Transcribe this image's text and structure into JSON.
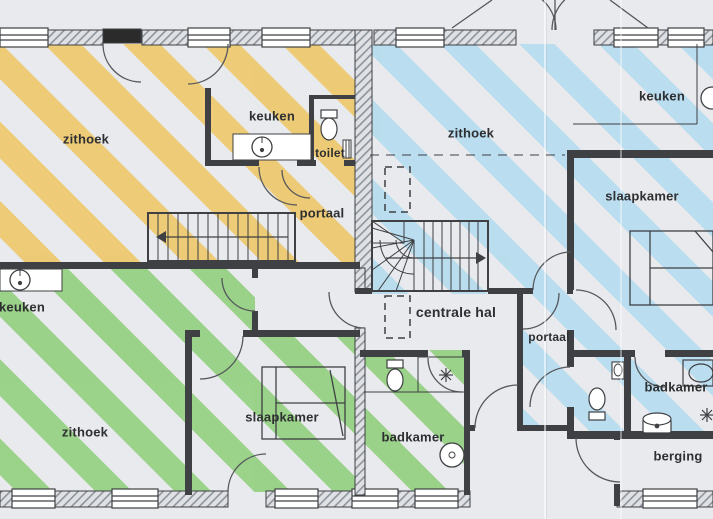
{
  "floorplan": {
    "type": "scanned architectural floor plan, three apartments marked with coloured highlighter stripes",
    "apartments": {
      "yellow": {
        "color": "#eec769",
        "rooms": {
          "zithoek": "zithoek",
          "keuken": "keuken",
          "toilet": "toilet",
          "portaal": "portaal"
        }
      },
      "blue": {
        "color": "#b5dcef",
        "rooms": {
          "zithoek": "zithoek",
          "keuken": "keuken",
          "slaapkamer": "slaapkamer",
          "portaal": "portaal",
          "badkamer": "badkamer",
          "berging": "berging"
        }
      },
      "green": {
        "color": "#92d07f",
        "rooms": {
          "keuken": "keuken",
          "zithoek": "zithoek",
          "slaapkamer": "slaapkamer",
          "badkamer": "badkamer"
        }
      }
    },
    "shared": {
      "centrale_hal": "centrale hal"
    },
    "colors": {
      "wall": "#3e4043",
      "paper": "#e9eaed",
      "hatch_line": "#8e949c",
      "hatch_bg": "#dfe1e4"
    }
  }
}
